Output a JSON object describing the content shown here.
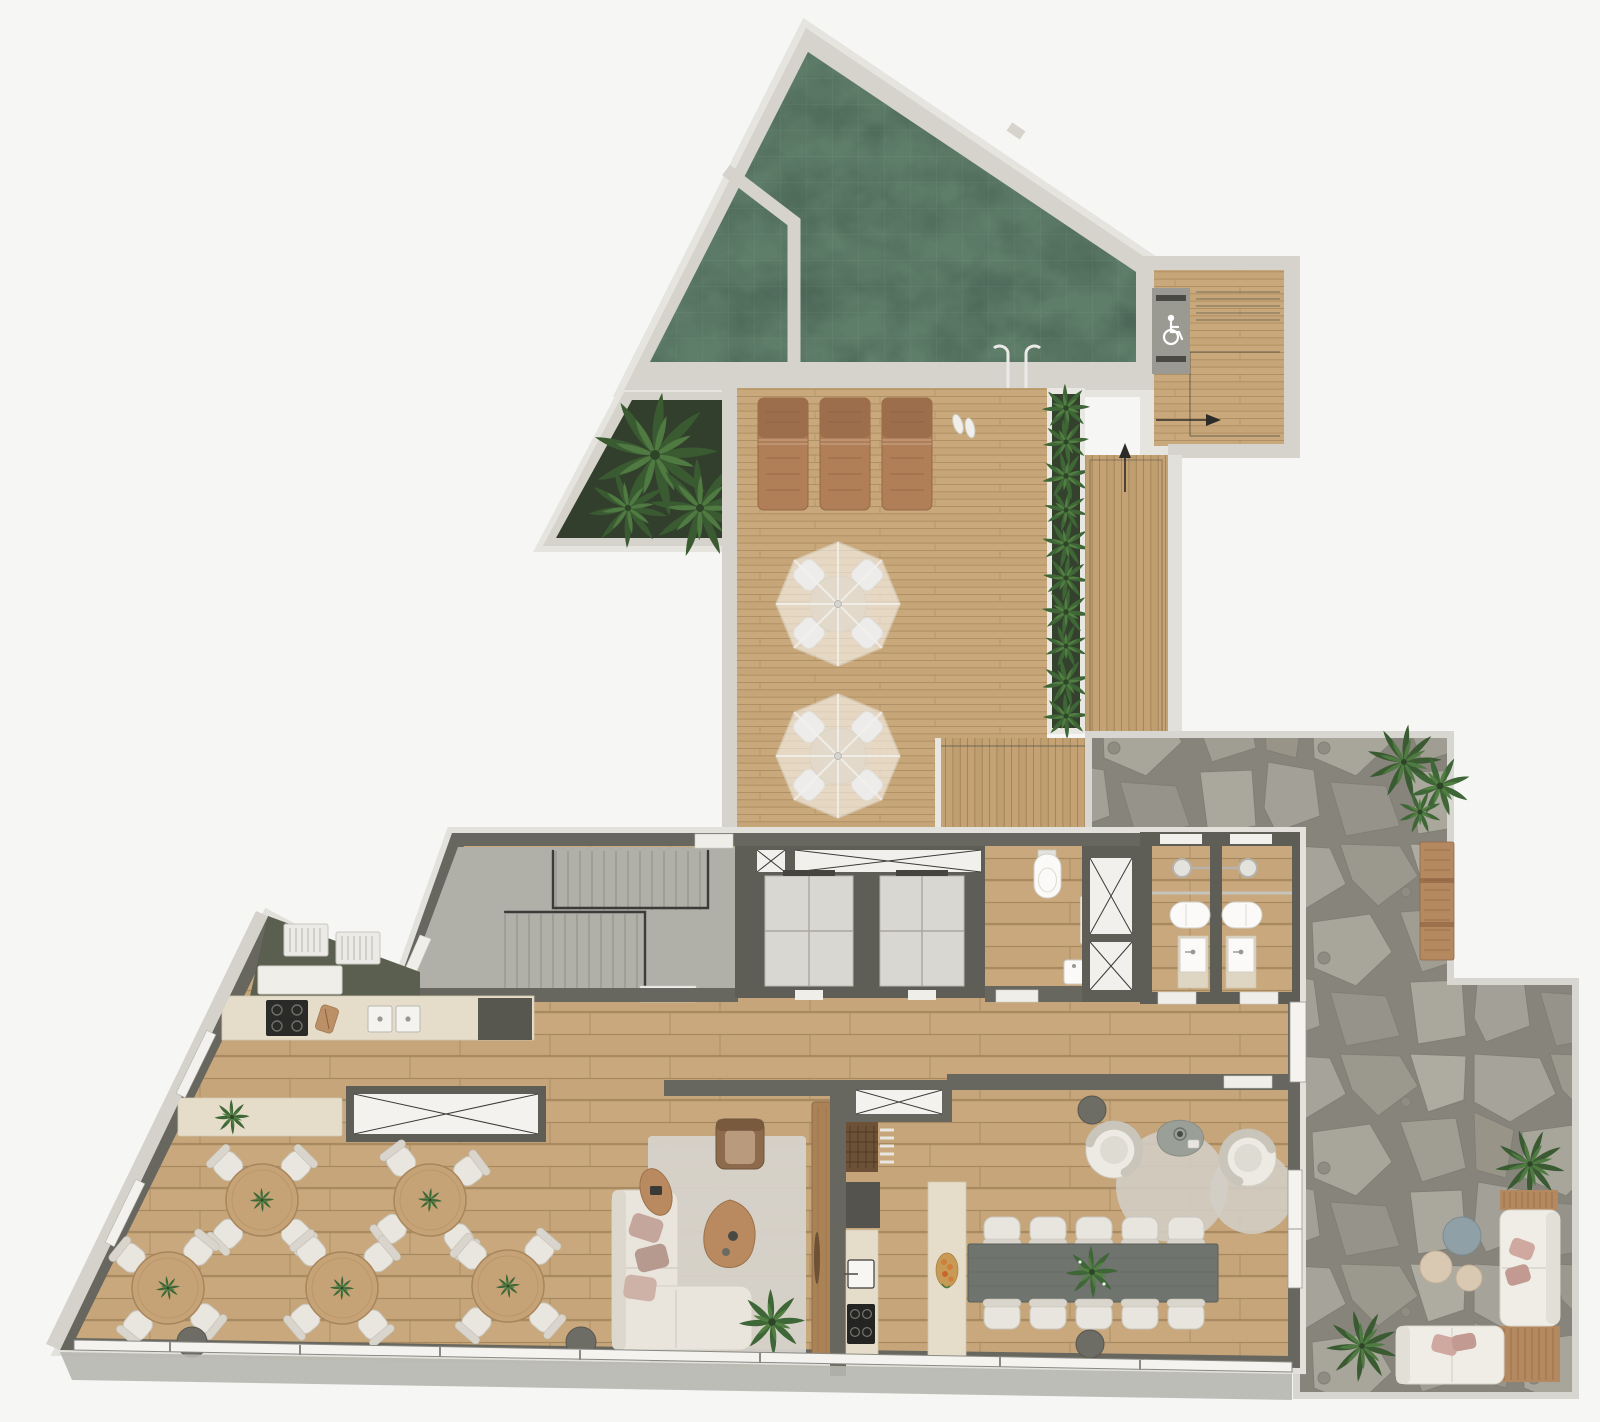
{
  "meta": {
    "title": "Floor plan",
    "type": "architectural floor plan render",
    "view": "top-down",
    "width_px": 1600,
    "height_px": 1422
  },
  "palette": {
    "background": "#f6f6f5",
    "wall": "#67665f",
    "wall_edge": "#e3e1dc",
    "concrete_deck": "#d6d3cc",
    "concrete_floor": "#b0b0a8",
    "pool_water": "#4a6454",
    "pool_water_light": "#5d7a63",
    "planter_soil": "#323f2c",
    "leaf_dark": "#3a5a31",
    "leaf_light": "#4f7a42",
    "deck_wood": "#c9a97b",
    "floor_wood": "#c8a87c",
    "stone_base": "#a19e95",
    "stone_joint": "#87847c",
    "counter_beige": "#e5ddca",
    "cabinet_dark": "#55544d",
    "table_dark": "#70746f",
    "furniture_cream": "#e9e5dc",
    "lounger_wood": "#b07e57",
    "door_wood": "#ab8256",
    "rug": "#d7d4ce",
    "pillow_pink": "#c4a69c",
    "pouf_blue": "#8fa0a6",
    "column": "#6d6c65"
  },
  "areas": {
    "pool": {
      "label": "Swimming pool",
      "features": [
        "main pool",
        "kids pool behind divider wall",
        "pool ladder",
        "entry step"
      ]
    },
    "pool_lift": {
      "label": "Accessible pool lift platform",
      "icon": "wheelchair-icon"
    },
    "palm_planter": {
      "label": "Palm planter",
      "palms": 3
    },
    "sun_deck": {
      "label": "Timber sun deck",
      "loungers": 3,
      "parasol_sets": 2,
      "extras": [
        "flip flops"
      ]
    },
    "hedge_planter": {
      "label": "Hedge planter strip",
      "shrubs": 10
    },
    "deck_stairs": {
      "label": "Deck stairs and ramp",
      "icons": [
        "up-arrow",
        "right-arrow"
      ]
    },
    "stair_hall": {
      "label": "Staircase hall",
      "features": [
        "u-shaped stair",
        "concrete floor"
      ]
    },
    "elevators": {
      "label": "Elevator lobby",
      "elevators": 2,
      "shafts": 2
    },
    "wc": {
      "label": "Toilet room",
      "features": [
        "wall-hung toilet",
        "corner basin",
        "grab bar"
      ]
    },
    "bathrooms": {
      "label": "Shower rooms",
      "count": 2,
      "features": [
        "rain shower",
        "toilet",
        "pedestal basin"
      ]
    },
    "kitchen": {
      "label": "Kitchen",
      "features": [
        "4-burner cooktop",
        "double sink",
        "cutting board",
        "barbecue grills",
        "tall cabinet"
      ]
    },
    "restaurant": {
      "label": "Dining terrace",
      "tables": 5,
      "chairs_per_table": 4
    },
    "console": {
      "label": "Sideboard with plant"
    },
    "lounge": {
      "label": "Lounge",
      "features": [
        "l-shaped sofa",
        "armchair",
        "2 organic coffee tables",
        "rug",
        "floor plant",
        "timber door panel"
      ]
    },
    "kitchenette": {
      "label": "Support kitchenette",
      "features": [
        "sink",
        "cooktop",
        "pantry rack",
        "tall cabinet"
      ]
    },
    "party_room": {
      "label": "Gourmet room",
      "table_seats": 10,
      "features": [
        "stone island with fruit platter",
        "2 swivel armchairs",
        "organic side table",
        "2 round rugs"
      ]
    },
    "patio": {
      "label": "Stone patio",
      "features": [
        "flagstone paving",
        "timber bench",
        "ferns",
        "3 poufs",
        "2 outdoor sofas",
        "timber pads"
      ]
    }
  },
  "icons": {
    "wheelchair": "accessible pool lift",
    "arrow_up": "circulation direction",
    "arrow_right": "circulation direction"
  },
  "counts": {
    "dining_tables": 5,
    "dining_chairs": 20,
    "sun_loungers": 3,
    "parasols": 2,
    "elevators": 2,
    "party_table_chairs": 10,
    "columns": 4,
    "poufs": 3,
    "outdoor_sofas": 2
  }
}
